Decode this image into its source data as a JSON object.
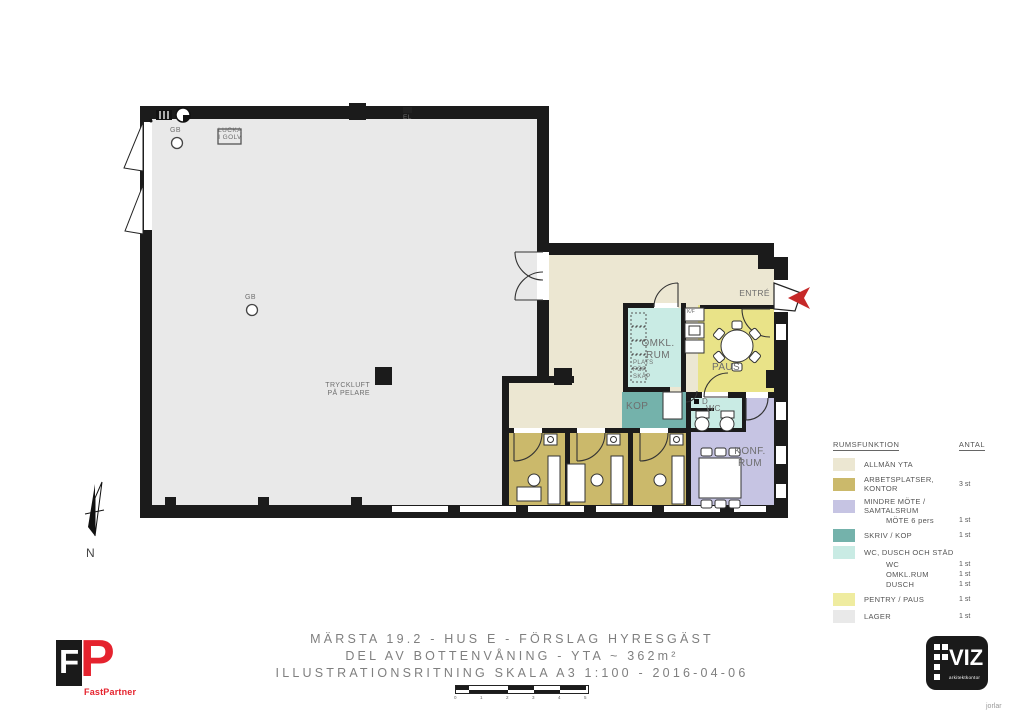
{
  "colors": {
    "allman_yta": "#ece7d2",
    "kontor": "#cbb96b",
    "mote": "#c6c4e3",
    "skriv_kop": "#74b2ab",
    "wc_dusch": "#c9ebe4",
    "pentry_paus": "#e9e388",
    "pentry_swatch": "#efeca0",
    "lager": "#e9e9e9",
    "arrow_red": "#c62828",
    "logo_red": "#e5232e",
    "logo_black": "#1a1a1a"
  },
  "plan": {
    "entre": "ENTRÉ",
    "omkl_line1": "OMKL.",
    "omkl_line2": "RUM",
    "plats_line1": "PLATS",
    "plats_line2": "FÖR",
    "plats_line3": "SKÅP",
    "kf": "K/F",
    "paus": "PAUS",
    "kop": "KOP",
    "dusch": "D",
    "wc": "WC",
    "konf_line1": "KONF.",
    "konf_line2": "RUM",
    "tryckluft_line1": "TRYCKLUFT",
    "tryckluft_line2": "PÅ PELARE",
    "gb": "GB",
    "lucka_line1": "LUCKA",
    "lucka_line2": "I GOLV",
    "el": "EL",
    "north": "N"
  },
  "legend": {
    "header_label": "RUMSFUNKTION",
    "header_count": "ANTAL",
    "rows": [
      {
        "label": "ALLMÄN YTA",
        "count": ""
      },
      {
        "label": "ARBETSPLATSER, KONTOR",
        "count": "3 st"
      },
      {
        "label": "MINDRE MÖTE / SAMTALSRUM",
        "count": ""
      },
      {
        "label": "MÖTE 6 pers",
        "count": "1 st"
      },
      {
        "label": "SKRIV / KOP",
        "count": "1 st"
      },
      {
        "label": "WC, DUSCH OCH STÄD",
        "count": ""
      },
      {
        "label": "WC",
        "count": "1 st"
      },
      {
        "label": "OMKL.RUM",
        "count": "1 st"
      },
      {
        "label": "DUSCH",
        "count": "1 st"
      },
      {
        "label": "PENTRY / PAUS",
        "count": "1 st"
      },
      {
        "label": "LAGER",
        "count": "1 st"
      }
    ]
  },
  "footer": {
    "title_line1": "MÄRSTA 19.2 - HUS E - FÖRSLAG HYRESGÄST",
    "title_line2": "DEL AV BOTTENVÅNING - YTA ~ 362m²",
    "title_line3": "ILLUSTRATIONSRITNING SKALA A3 1:100 - 2016-04-06",
    "scale_ticks": [
      "0",
      "1",
      "2",
      "3",
      "4",
      "5"
    ],
    "fastpartner_letter_f": "F",
    "fastpartner_letter_p": "P",
    "fastpartner_name": "FastPartner",
    "viz_name": "VIZ",
    "viz_sub": "arkitektkontor",
    "credit": "jorlar"
  }
}
